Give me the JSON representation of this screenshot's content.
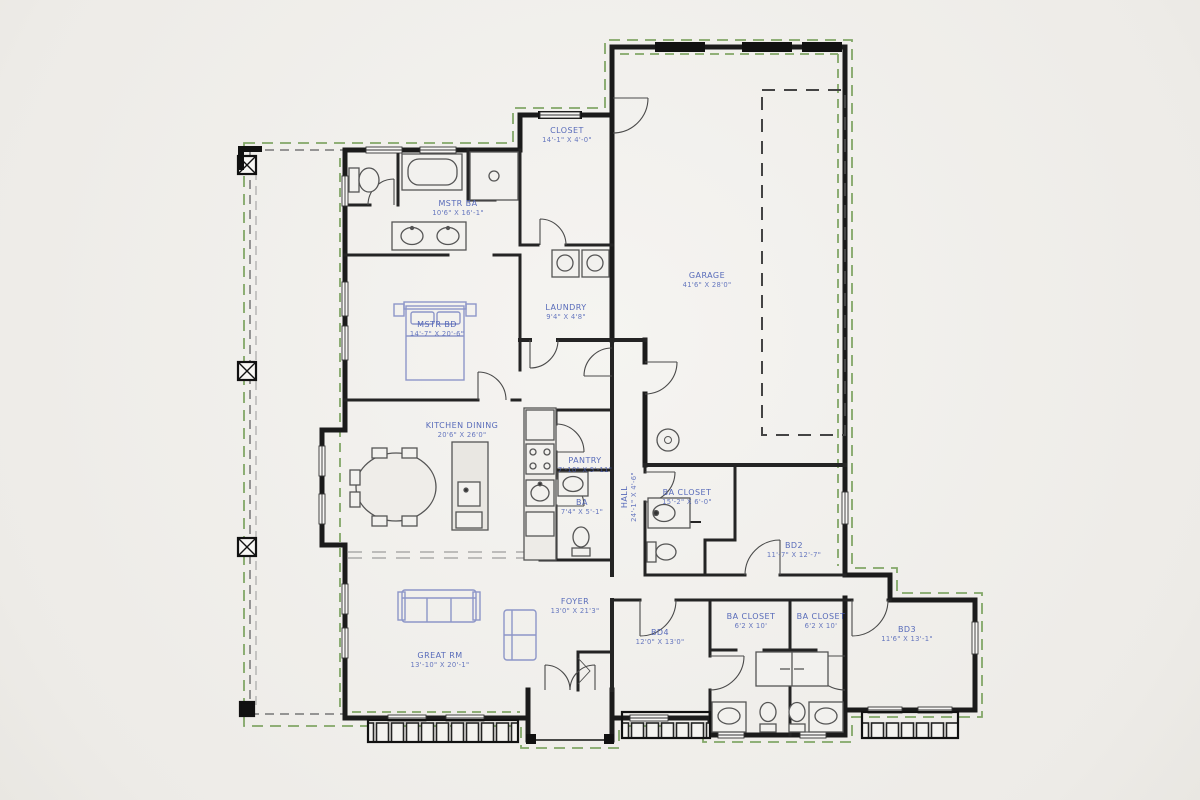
{
  "drawing_type": "residential floor plan",
  "colors": {
    "paper": "#f5f4f1",
    "wall": "#1b1b1b",
    "overhang_green": "#6f9a50",
    "label_blue": "#4a5fb5",
    "furniture_blue": "#8d96c8",
    "fixture_gray": "#555555"
  },
  "rooms": [
    {
      "name": "CLOSET",
      "dims": "14'-1\" X 4'-0\""
    },
    {
      "name": "MSTR BA",
      "dims": "10'6\" X 16'-1\""
    },
    {
      "name": "GARAGE",
      "dims": "41'6\" X 28'0\""
    },
    {
      "name": "LAUNDRY",
      "dims": "9'4\" X 4'8\""
    },
    {
      "name": "MSTR BD",
      "dims": "14'-7\" X 20'-6\""
    },
    {
      "name": "KITCHEN DINING",
      "dims": "20'6\" X 26'0\""
    },
    {
      "name": "PANTRY",
      "dims": "7'-10\" X 5'-11\""
    },
    {
      "name": "BA",
      "dims": "7'4\" X 5'-1\""
    },
    {
      "name": "HALL",
      "dims": "24'-1\" X 4'-6\""
    },
    {
      "name": "BA CLOSET",
      "dims": "15'-2\" X 6'-0\""
    },
    {
      "name": "BD2",
      "dims": "11'-7\" X 12'-7\""
    },
    {
      "name": "FOYER",
      "dims": "13'0\" X 21'3\""
    },
    {
      "name": "BD4",
      "dims": "12'0\" X 13'0\""
    },
    {
      "name": "BA CLOSET",
      "dims": "6'2 X 10'"
    },
    {
      "name": "BA CLOSET",
      "dims": "6'2 X 10'"
    },
    {
      "name": "BD3",
      "dims": "11'6\" X 13'-1\""
    },
    {
      "name": "GREAT RM",
      "dims": "13'-10\" X 20'-1\""
    }
  ]
}
